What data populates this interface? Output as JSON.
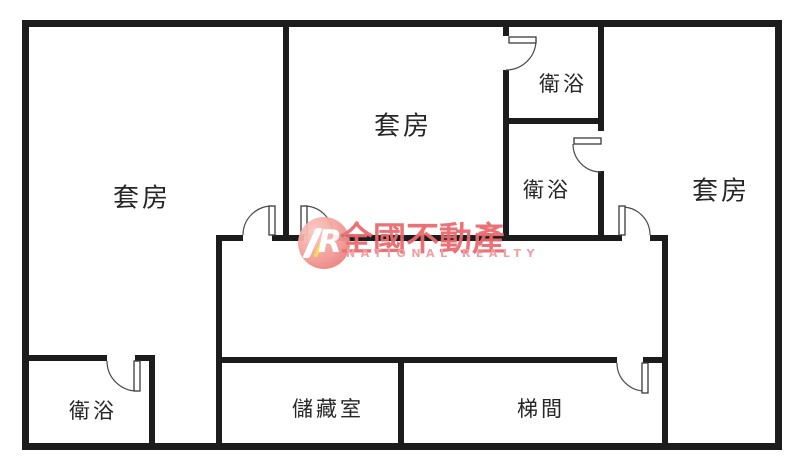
{
  "plan_type": "residential floor plan",
  "rooms": [
    {
      "id": "suite-left",
      "label": "套房"
    },
    {
      "id": "suite-middle",
      "label": "套房"
    },
    {
      "id": "suite-right",
      "label": "套房"
    },
    {
      "id": "bathroom-top",
      "label": "衛浴"
    },
    {
      "id": "bathroom-middle",
      "label": "衛浴"
    },
    {
      "id": "bathroom-bottom-left",
      "label": "衛浴"
    },
    {
      "id": "storage-room",
      "label": "儲藏室"
    },
    {
      "id": "stairwell",
      "label": "梯間"
    }
  ],
  "watermark": {
    "logo_letter": "R",
    "brand_zh": "全國不動產",
    "brand_en": "NATIONAL REALTY"
  },
  "colors": {
    "wall": "#1c1c1c",
    "background": "#ffffff",
    "watermark_red": "#e96a6e",
    "watermark_pink": "#f09aa0",
    "watermark_logo_circle": "#ee8280",
    "watermark_gold": "#ffd94d"
  }
}
